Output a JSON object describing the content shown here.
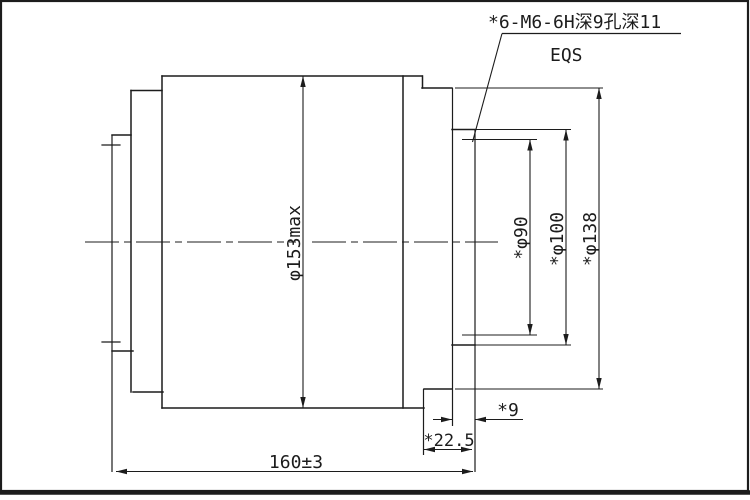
{
  "drawing": {
    "type": "engineering-part-drawing",
    "annotations": {
      "holes_note": "*6-M6-6H深9孔深11",
      "spacing_note": "EQS"
    },
    "dimensions": {
      "outer_max_diameter": "φ153max",
      "bolt_circle_diameter": "*φ90",
      "spigot_diameter": "*φ100",
      "flange_diameter": "*φ138",
      "spigot_length": "*9",
      "right_section_length": "*22.5",
      "overall_length": "160±3"
    },
    "colors": {
      "line": "#1c1c1c",
      "background": "#ffffff"
    }
  }
}
